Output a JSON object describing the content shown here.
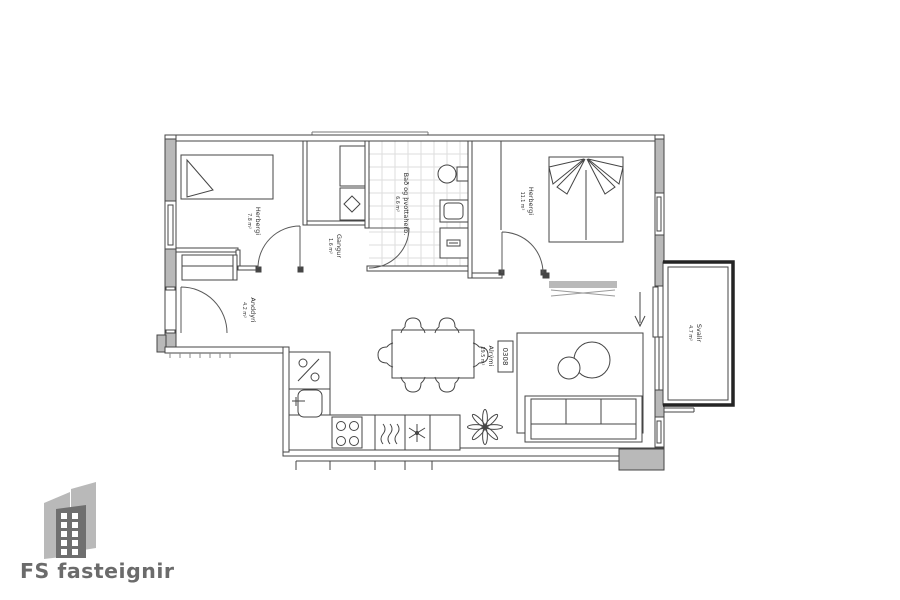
{
  "branding": {
    "logo_text": "FS fasteignir"
  },
  "floorplan": {
    "unit_number": "0308",
    "rooms": [
      {
        "name": "Herbergi",
        "area": "7.8 m²"
      },
      {
        "name": "Gangur",
        "area": "1.6 m²"
      },
      {
        "name": "Bað og þvottaherb.",
        "area": "6.6 m²"
      },
      {
        "name": "Herbergi",
        "area": "11.1 m²"
      },
      {
        "name": "Anddyri",
        "area": "4.2 m²"
      },
      {
        "name": "Alrými",
        "area": "29.5 m²"
      },
      {
        "name": "Svalir",
        "area": "4.7 m²"
      }
    ],
    "symbols": {
      "fridge": "%"
    }
  },
  "colors": {
    "line": "#454545",
    "wall_fill": "#b9b9b9",
    "tile": "#dedede",
    "balcony_border": "#242424",
    "logo_gray": "#b9b9b9",
    "logo_dark": "#6f6f6f",
    "logo_text": "#6b6b6b"
  }
}
